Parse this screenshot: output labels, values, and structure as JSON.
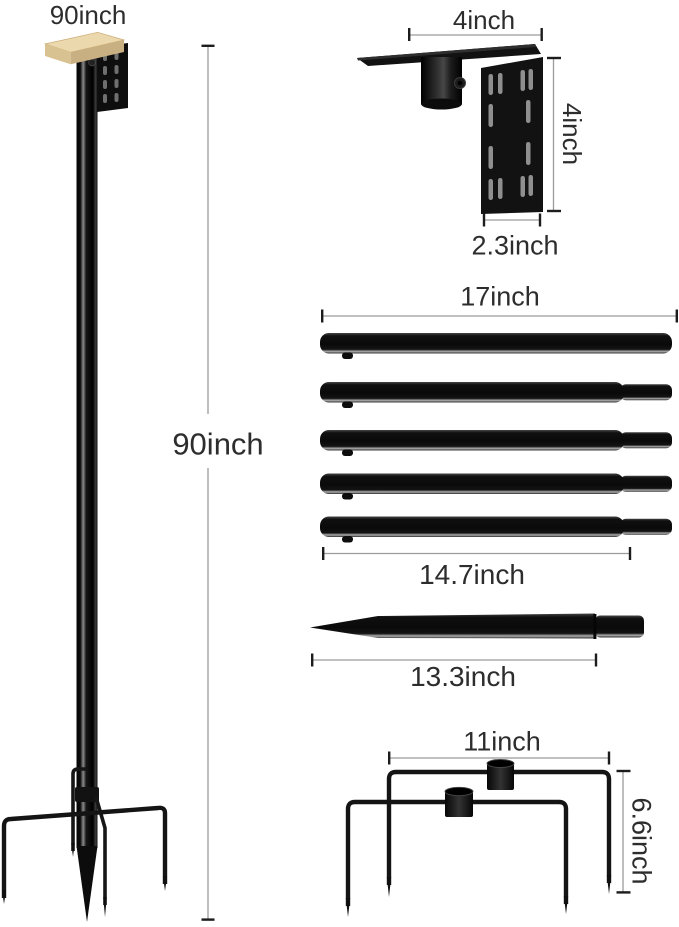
{
  "page": {
    "background": "#ffffff"
  },
  "parts": {
    "assembled_pole": {
      "name": "assembled 90 inch pole with 5-prong base",
      "top_label": "90inch",
      "height_label": "90inch"
    },
    "hanging_bracket": {
      "name": "side mount bracket with pole socket",
      "top_width_label": "4inch",
      "side_height_label": "4inch",
      "plate_width_label": "2.3inch"
    },
    "pole_sections": {
      "name": "five interlocking pole sections",
      "count": 5,
      "overall_length_label": "17inch",
      "section_length_label": "14.7inch"
    },
    "ground_spike": {
      "name": "tapered ground spike section",
      "length_label": "13.3inch"
    },
    "prong_base": {
      "name": "two-piece prong ground base with sockets",
      "width_label": "11inch",
      "height_label": "6.6inch"
    }
  },
  "colors": {
    "part_black": "#111111",
    "dimension_line": "#9b9b9b",
    "tick": "#1c1c1c",
    "wood_top": "#ecd8ad",
    "text_color": "#2d2d2d"
  }
}
